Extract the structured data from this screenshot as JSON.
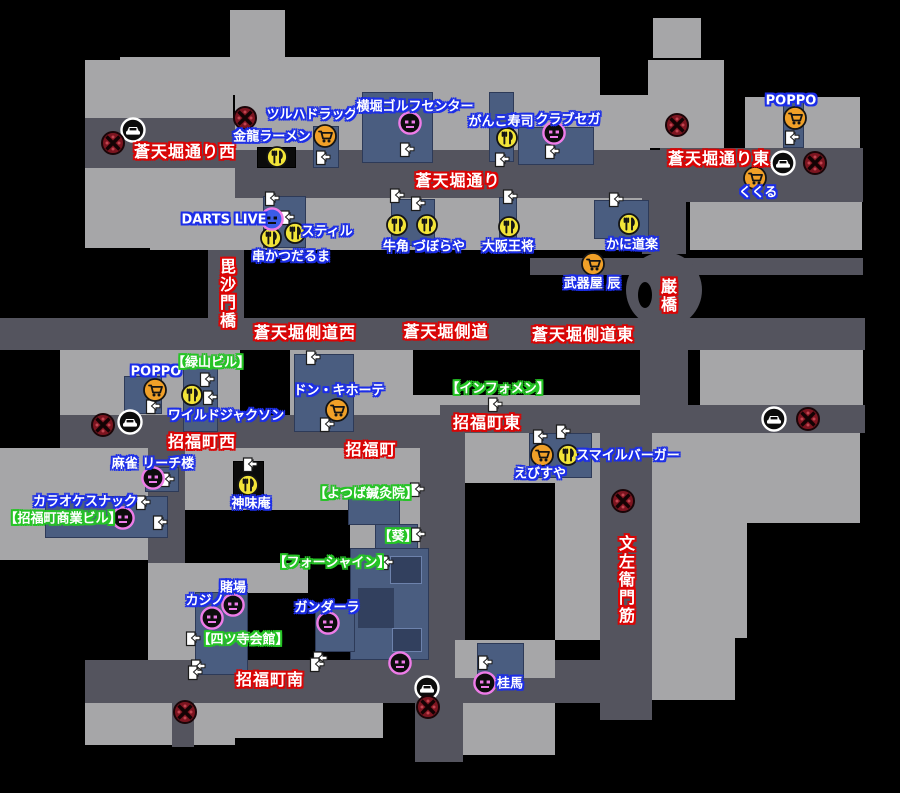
{
  "map": {
    "colors": {
      "block": "#a6a6a8",
      "street": "#54545e",
      "building": "#4a5d80",
      "street_label_outline": "#dc0404",
      "shop_label_outline": "#1c2ee8",
      "landmark_label_outline": "#25c425",
      "restaurant_icon": "#f2e438",
      "shop_icon": "#f0a028",
      "minigame_icon": "#ee7ce8",
      "darts_icon_face": "#3c5ce8",
      "save_icon": "#7c1520",
      "taxi_ring": "#ffffff"
    },
    "street_labels": [
      {
        "text": "蒼天堀通り西",
        "x": 185,
        "y": 152
      },
      {
        "text": "蒼天堀通り",
        "x": 458,
        "y": 181
      },
      {
        "text": "蒼天堀通り東",
        "x": 719,
        "y": 159
      },
      {
        "text": "蒼天堀側道西",
        "x": 305,
        "y": 333
      },
      {
        "text": "蒼天堀側道",
        "x": 446,
        "y": 332
      },
      {
        "text": "蒼天堀側道東",
        "x": 583,
        "y": 335
      },
      {
        "text": "招福町西",
        "x": 202,
        "y": 442
      },
      {
        "text": "招福町",
        "x": 371,
        "y": 450
      },
      {
        "text": "招福町東",
        "x": 487,
        "y": 423
      },
      {
        "text": "招福町南",
        "x": 270,
        "y": 680
      },
      {
        "text": "毘沙門橋",
        "x": 226,
        "y": 294,
        "vertical": true
      },
      {
        "text": "巌橋",
        "x": 667,
        "y": 296,
        "vertical": true
      },
      {
        "text": "文左衛門筋",
        "x": 625,
        "y": 580,
        "vertical": true
      }
    ],
    "shop_labels": [
      {
        "text": "金龍ラーメン",
        "x": 272,
        "y": 137
      },
      {
        "text": "ツルハドラッグ",
        "x": 312,
        "y": 115
      },
      {
        "text": "横堀ゴルフセンター",
        "x": 415,
        "y": 107
      },
      {
        "text": "がんこ寿司",
        "x": 501,
        "y": 122
      },
      {
        "text": "クラブセガ",
        "x": 568,
        "y": 120
      },
      {
        "text": "POPPO",
        "x": 791,
        "y": 101
      },
      {
        "text": "くくる",
        "x": 758,
        "y": 193
      },
      {
        "text": "DARTS LIVE",
        "x": 224,
        "y": 220
      },
      {
        "text": "スティル",
        "x": 327,
        "y": 232
      },
      {
        "text": "串かつだるま",
        "x": 291,
        "y": 257
      },
      {
        "text": "牛角",
        "x": 396,
        "y": 247
      },
      {
        "text": "づぼらや",
        "x": 439,
        "y": 247
      },
      {
        "text": "大阪王将",
        "x": 508,
        "y": 247
      },
      {
        "text": "かに道楽",
        "x": 632,
        "y": 245
      },
      {
        "text": "武器屋 辰",
        "x": 592,
        "y": 284
      },
      {
        "text": "POPPO",
        "x": 156,
        "y": 372
      },
      {
        "text": "ワイルドジャクソン",
        "x": 226,
        "y": 416
      },
      {
        "text": "ドン・キホーテ",
        "x": 339,
        "y": 391
      },
      {
        "text": "麻雀 リーチ楼",
        "x": 153,
        "y": 464
      },
      {
        "text": "スマイルバーガー",
        "x": 628,
        "y": 456
      },
      {
        "text": "えびすや",
        "x": 540,
        "y": 474
      },
      {
        "text": "カラオケスナック",
        "x": 85,
        "y": 502
      },
      {
        "text": "神味庵",
        "x": 251,
        "y": 504
      },
      {
        "text": "カジノ",
        "x": 205,
        "y": 601
      },
      {
        "text": "賭場",
        "x": 233,
        "y": 588
      },
      {
        "text": "ガンダーラ",
        "x": 327,
        "y": 608
      },
      {
        "text": "桂馬",
        "x": 510,
        "y": 684
      }
    ],
    "landmark_labels": [
      {
        "text": "【緑山ビル】",
        "x": 211,
        "y": 363
      },
      {
        "text": "【インフォメン】",
        "x": 498,
        "y": 389
      },
      {
        "text": "【招福町商業ビル】",
        "x": 63,
        "y": 519
      },
      {
        "text": "【よつば鍼灸院】",
        "x": 366,
        "y": 494
      },
      {
        "text": "【葵】",
        "x": 398,
        "y": 537
      },
      {
        "text": "【フォーシャイン】",
        "x": 332,
        "y": 563
      },
      {
        "text": "【四ツ寺会館】",
        "x": 243,
        "y": 640
      }
    ],
    "icons": {
      "restaurant": [
        [
          277,
          157
        ],
        [
          507,
          138
        ],
        [
          271,
          238
        ],
        [
          295,
          233
        ],
        [
          397,
          225
        ],
        [
          427,
          225
        ],
        [
          509,
          227
        ],
        [
          629,
          224
        ],
        [
          192,
          395
        ],
        [
          568,
          455
        ],
        [
          248,
          485
        ]
      ],
      "shop": [
        [
          325,
          136
        ],
        [
          795,
          118
        ],
        [
          755,
          178
        ],
        [
          593,
          264
        ],
        [
          155,
          390
        ],
        [
          337,
          410
        ],
        [
          542,
          455
        ]
      ],
      "minigame": [
        [
          410,
          123
        ],
        [
          554,
          133
        ],
        [
          153,
          478
        ],
        [
          123,
          518
        ],
        [
          233,
          605
        ],
        [
          212,
          618
        ],
        [
          328,
          623
        ],
        [
          400,
          663
        ],
        [
          485,
          683
        ]
      ],
      "darts": [
        [
          272,
          219
        ]
      ],
      "taxi": [
        [
          133,
          130
        ],
        [
          783,
          163
        ],
        [
          130,
          422
        ],
        [
          774,
          419
        ],
        [
          427,
          688
        ]
      ],
      "save": [
        [
          113,
          143
        ],
        [
          245,
          118
        ],
        [
          677,
          125
        ],
        [
          815,
          163
        ],
        [
          103,
          425
        ],
        [
          808,
          419
        ],
        [
          623,
          501
        ],
        [
          185,
          712
        ],
        [
          428,
          707
        ]
      ]
    },
    "doors": [
      [
        323,
        158
      ],
      [
        407,
        150
      ],
      [
        502,
        160
      ],
      [
        552,
        152
      ],
      [
        792,
        138
      ],
      [
        272,
        199
      ],
      [
        287,
        218
      ],
      [
        397,
        196
      ],
      [
        418,
        204
      ],
      [
        510,
        197
      ],
      [
        616,
        200
      ],
      [
        313,
        358
      ],
      [
        207,
        380
      ],
      [
        210,
        398
      ],
      [
        153,
        407
      ],
      [
        327,
        425
      ],
      [
        495,
        405
      ],
      [
        540,
        437
      ],
      [
        563,
        432
      ],
      [
        250,
        465
      ],
      [
        167,
        480
      ],
      [
        143,
        503
      ],
      [
        160,
        523
      ],
      [
        417,
        490
      ],
      [
        418,
        535
      ],
      [
        386,
        563
      ],
      [
        193,
        639
      ],
      [
        198,
        667
      ],
      [
        320,
        659
      ],
      [
        317,
        665
      ],
      [
        485,
        663
      ],
      [
        195,
        673
      ]
    ]
  }
}
